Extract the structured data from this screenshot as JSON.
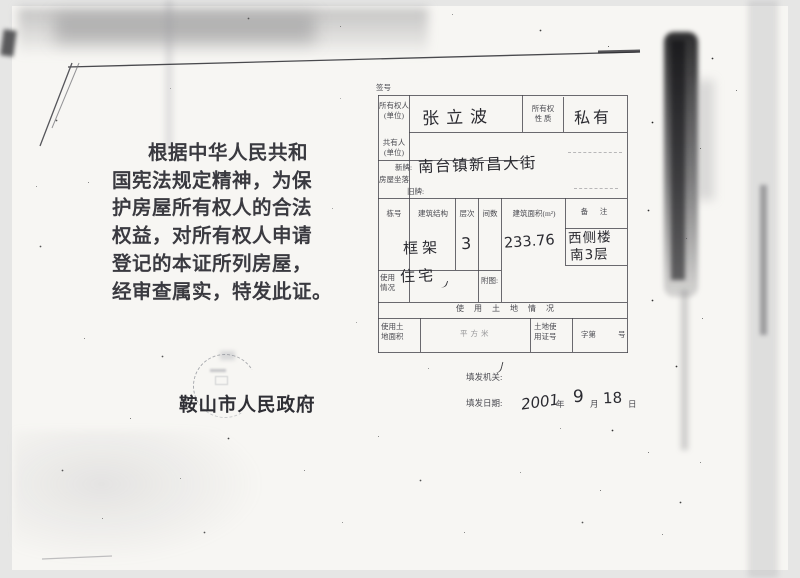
{
  "page": {
    "certificate_text": [
      "根据中华人民共和",
      "国宪法规定精神，为保",
      "护房屋所有权人的合法",
      "权益，对所有权人申请",
      "登记的本证所列房屋，",
      "经审查属实，特发此证。"
    ],
    "issuing_government": "鞍山市人民政府"
  },
  "form": {
    "file_no_label": "签号",
    "owner": {
      "label1": "所有权人",
      "label2": "(单位)",
      "value": "张立波"
    },
    "ownership_nature": {
      "label1": "所有权",
      "label2": "性  质",
      "value": "私有"
    },
    "co_owner": {
      "label1": "共有人",
      "label2": "(单位)"
    },
    "location": {
      "label": "房屋坐落",
      "new_label": "新牌:",
      "new_value": "南台镇新昌大街",
      "old_label": "旧牌:"
    },
    "building": {
      "col_building_no": "栋号",
      "col_structure": "建筑结构",
      "col_floors": "层次",
      "col_rooms": "间数",
      "col_area": "建筑面积(m²)",
      "col_remark": "备  注",
      "structure": "框架",
      "floors": "3",
      "area": "233.76",
      "remark1": "西侧楼",
      "remark2": "南3层"
    },
    "usage": {
      "label1": "使用",
      "label2": "情况",
      "value": "住宅",
      "plan_label": "附图:"
    },
    "land": {
      "section_title": "使 用 土 地 情 况",
      "area_label1": "使用土",
      "area_label2": "地面积",
      "unit": "平方米",
      "cert_label1": "土地使",
      "cert_label2": "用证号",
      "zi": "字第",
      "hao": "号"
    },
    "issue": {
      "org_label": "填发机关:",
      "date_label": "填发日期:",
      "year": "2001",
      "year_suffix": "年",
      "month": "9",
      "month_suffix": "月",
      "day": "18",
      "day_suffix": "日"
    }
  }
}
